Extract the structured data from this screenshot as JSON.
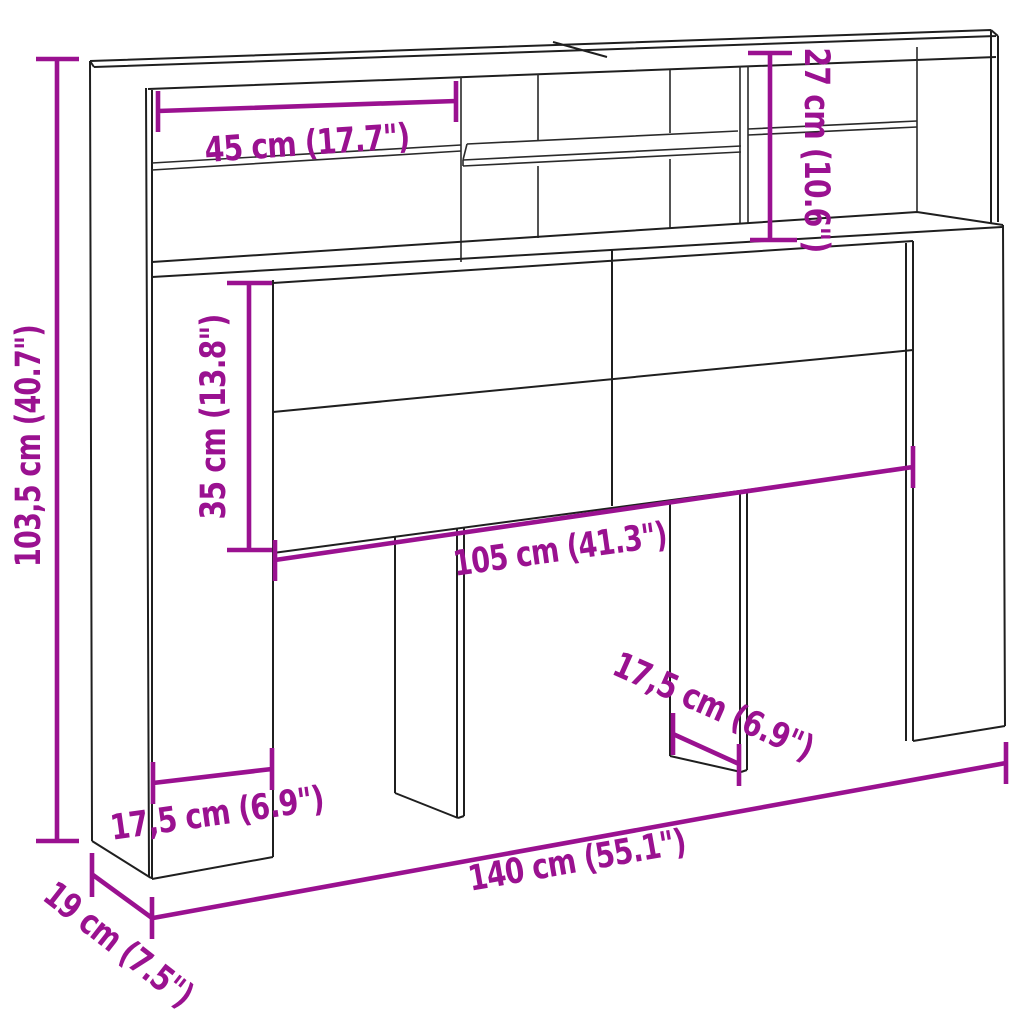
{
  "meta": {
    "type": "product-dimension-diagram",
    "subject": "headboard-storage-cabinet"
  },
  "colors": {
    "dimension_accent": "#9A1190",
    "line_color": "#1F1F1F",
    "background": "#FFFFFF"
  },
  "dims": [
    {
      "id": "top-shelf-width",
      "text": "45 cm (17.7\")"
    },
    {
      "id": "top-compartment-height",
      "text": "27 cm (10.6\")"
    },
    {
      "id": "overall-height",
      "text": "103,5 cm (40.7\")"
    },
    {
      "id": "front-panel-height",
      "text": "35 cm (13.8\")"
    },
    {
      "id": "front-panel-width",
      "text": "105 cm (41.3\")"
    },
    {
      "id": "middle-leg-depth",
      "text": "17,5 cm (6.9\")"
    },
    {
      "id": "left-column-width",
      "text": "17,5 cm (6.9\")"
    },
    {
      "id": "overall-width",
      "text": "140 cm (55.1\")"
    },
    {
      "id": "overall-depth",
      "text": "19 cm (7.5\")"
    }
  ]
}
